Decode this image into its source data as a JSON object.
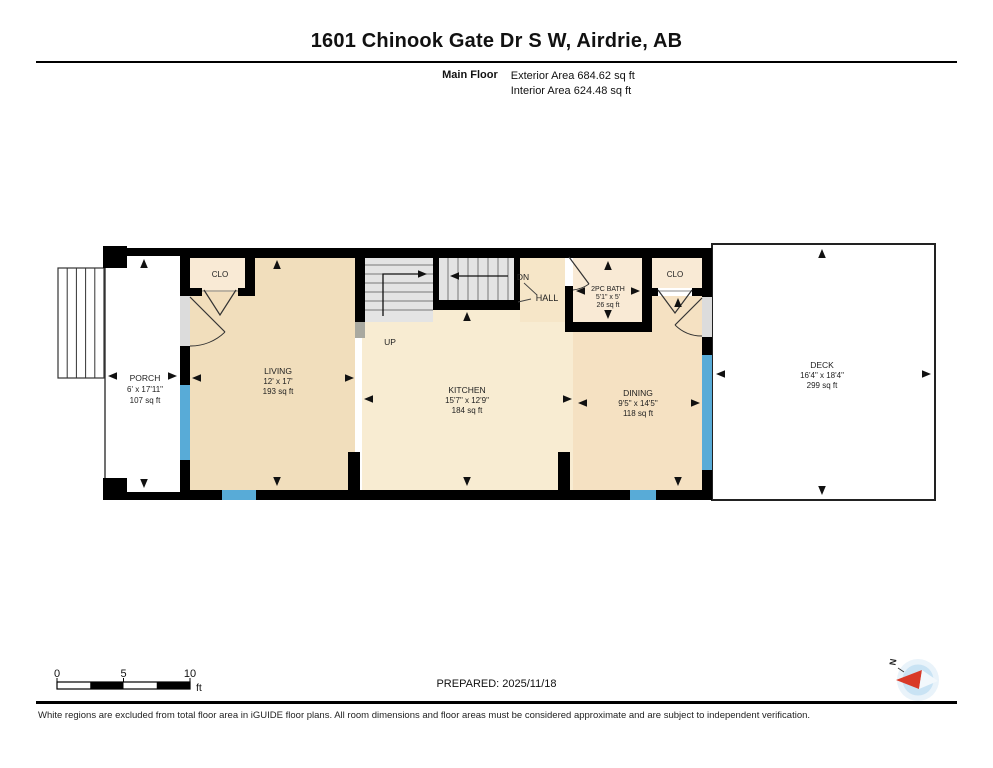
{
  "header": {
    "title": "1601 Chinook Gate Dr S W, Airdrie, AB",
    "floor_label": "Main Floor",
    "exterior_area": "Exterior Area 684.62 sq ft",
    "interior_area": "Interior Area 624.48 sq ft"
  },
  "rooms": {
    "porch": {
      "name": "PORCH",
      "dims": "6' x 17'11\"",
      "area": "107 sq ft"
    },
    "living": {
      "name": "LIVING",
      "dims": "12' x 17'",
      "area": "193 sq ft"
    },
    "kitchen": {
      "name": "KITCHEN",
      "dims": "15'7\" x 12'9\"",
      "area": "184 sq ft"
    },
    "dining": {
      "name": "DINING",
      "dims": "9'5\" x 14'5\"",
      "area": "118 sq ft"
    },
    "bath": {
      "name": "2PC BATH",
      "dims": "5'1\" x 5'",
      "area": "26 sq ft"
    },
    "deck": {
      "name": "DECK",
      "dims": "16'4\" x 18'4\"",
      "area": "299 sq ft"
    }
  },
  "plan_labels": {
    "closet_left": "CLO",
    "closet_right": "CLO",
    "hall": "HALL",
    "up": "UP",
    "down": "DN"
  },
  "scale_bar": {
    "tick_0": "0",
    "tick_5": "5",
    "tick_10": "10",
    "unit": "ft"
  },
  "compass": {
    "north_label": "N"
  },
  "footer": {
    "prepared": "PREPARED: 2025/11/18",
    "disclaimer": "White regions are excluded from total floor area in iGUIDE floor plans. All room dimensions and floor areas must be considered approximate and are subject to independent verification."
  },
  "colors": {
    "wall": "#000000",
    "floor_main": "#f1debc",
    "floor_kitchen": "#f8ecd2",
    "floor_hall": "#f6e6c8",
    "floor_dining": "#f5e1c2",
    "floor_closet": "#f9ead5",
    "stairs": "#e4e4e4",
    "window": "#58abd7",
    "door_gap": "#dcdcdc",
    "compass_red": "#d93a28",
    "compass_blue": "#c9e3f4",
    "compass_ring": "#e9f3fa"
  }
}
